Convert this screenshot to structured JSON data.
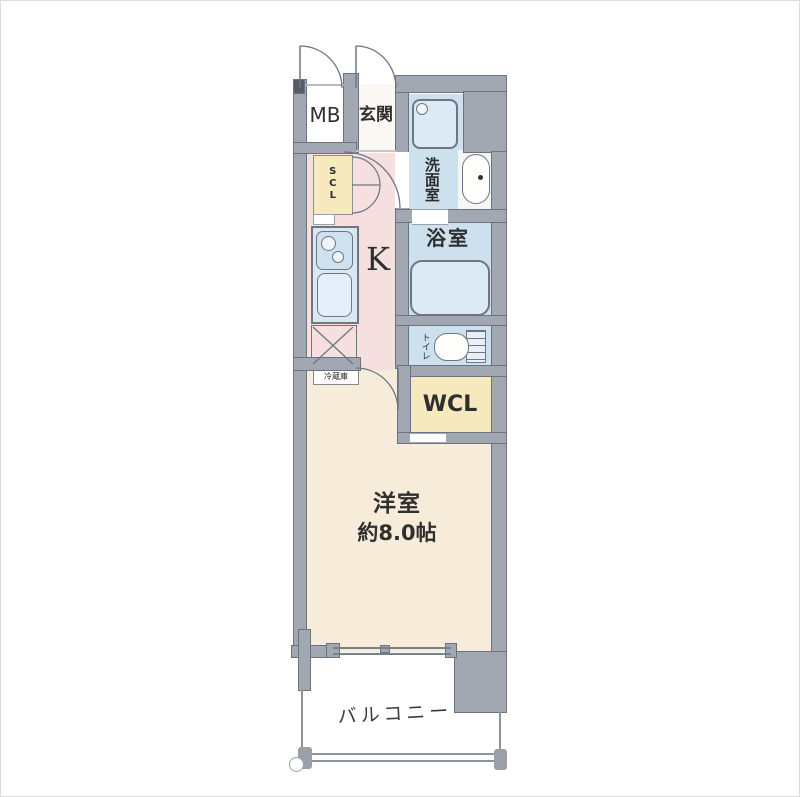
{
  "plan_title": "1K apartment floor plan",
  "rooms": {
    "meter_box": "MB",
    "entrance": "玄関",
    "shoe_closet": "SCL",
    "washroom": "洗面室",
    "bathroom": "浴室",
    "kitchen": "K",
    "toilet": "トイレ",
    "walk_in_closet": "WCL",
    "bedroom": "洋室",
    "bedroom_size": "約8.0帖",
    "balcony": "バルコニー",
    "refrigerator": "冷蔵庫"
  },
  "colors": {
    "wall": "#a2a8b2",
    "wall_edge": "#6b7280",
    "kitchen_hall_floor": "#f5dfdf",
    "wet_area_floor": "#cde0ee",
    "fixture_fill": "#dceaf5",
    "closet_fill": "#f6e9bd",
    "bedroom_floor": "#f6ecd9",
    "line": "#6d7681"
  }
}
